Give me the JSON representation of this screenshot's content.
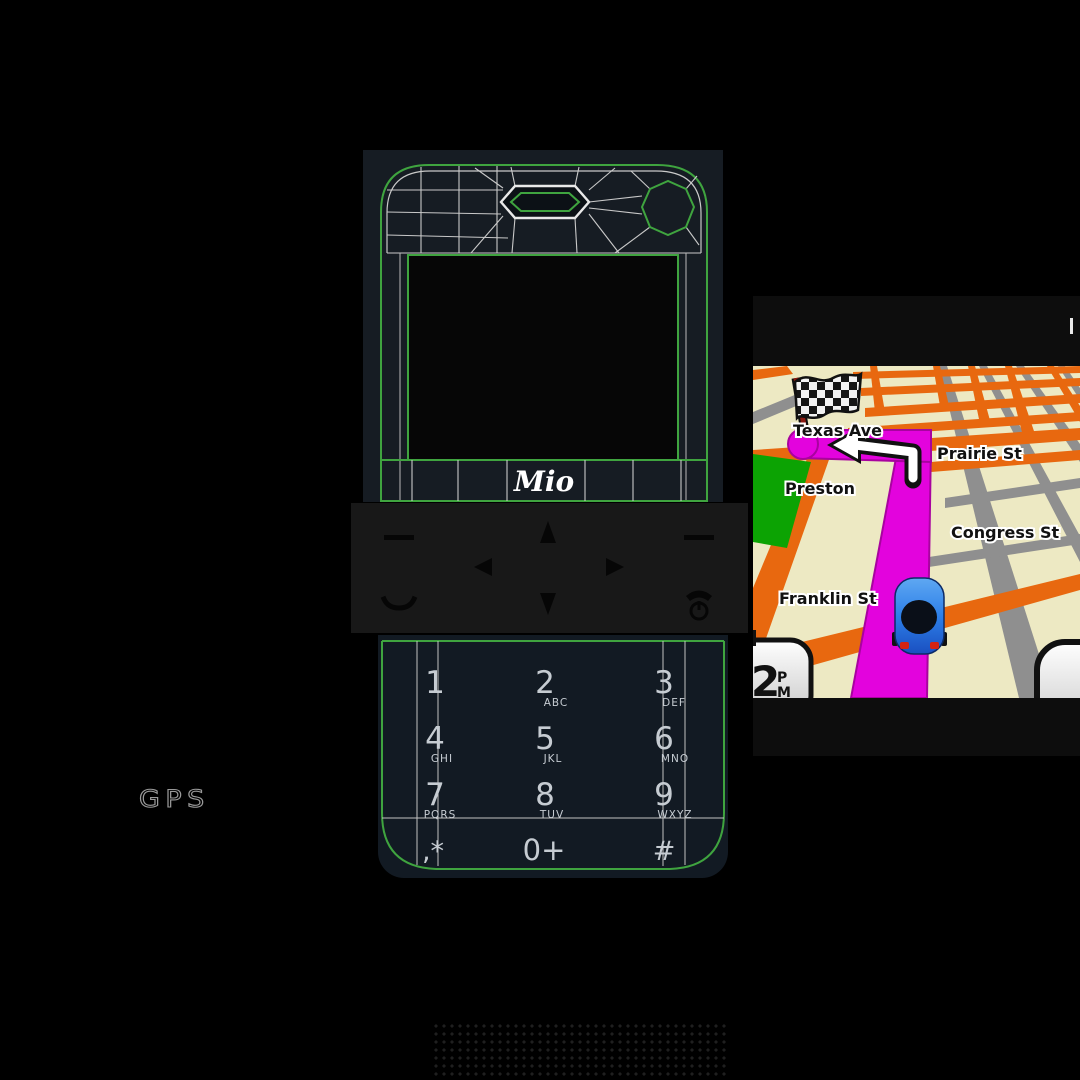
{
  "phone": {
    "brand_logo": "Mio",
    "keypad": {
      "keys": [
        {
          "digit": "1",
          "letters": ""
        },
        {
          "digit": "2",
          "letters": "ABC"
        },
        {
          "digit": "3",
          "letters": "DEF"
        },
        {
          "digit": "4",
          "letters": "GHI"
        },
        {
          "digit": "5",
          "letters": "JKL"
        },
        {
          "digit": "6",
          "letters": "MNO"
        },
        {
          "digit": "7",
          "letters": "PQRS"
        },
        {
          "digit": "8",
          "letters": "TUV"
        },
        {
          "digit": "9",
          "letters": "WXYZ"
        },
        {
          "digit": ",*",
          "letters": ""
        },
        {
          "digit": "0+",
          "letters": ""
        },
        {
          "digit": "#",
          "letters": ""
        }
      ]
    }
  },
  "watermark": {
    "gps_label": "GPS"
  },
  "nav_screen": {
    "streets": {
      "texas": "Texas Ave",
      "prairie": "Prairie St",
      "preston": "Preston",
      "congress": "Congress St",
      "franklin": "Franklin St"
    },
    "clock": {
      "hour": "2",
      "meridiem_line1": "P",
      "meridiem_line2": "M"
    },
    "colors": {
      "map_bg": "#EDE9C3",
      "road_primary": "#E8680F",
      "road_secondary": "#8F8F8F",
      "route": "#E303DD",
      "park": "#0CA303",
      "car": "#2D7FE8",
      "wireframe_green": "#3FA43F",
      "phone_body": "#161C23"
    }
  }
}
